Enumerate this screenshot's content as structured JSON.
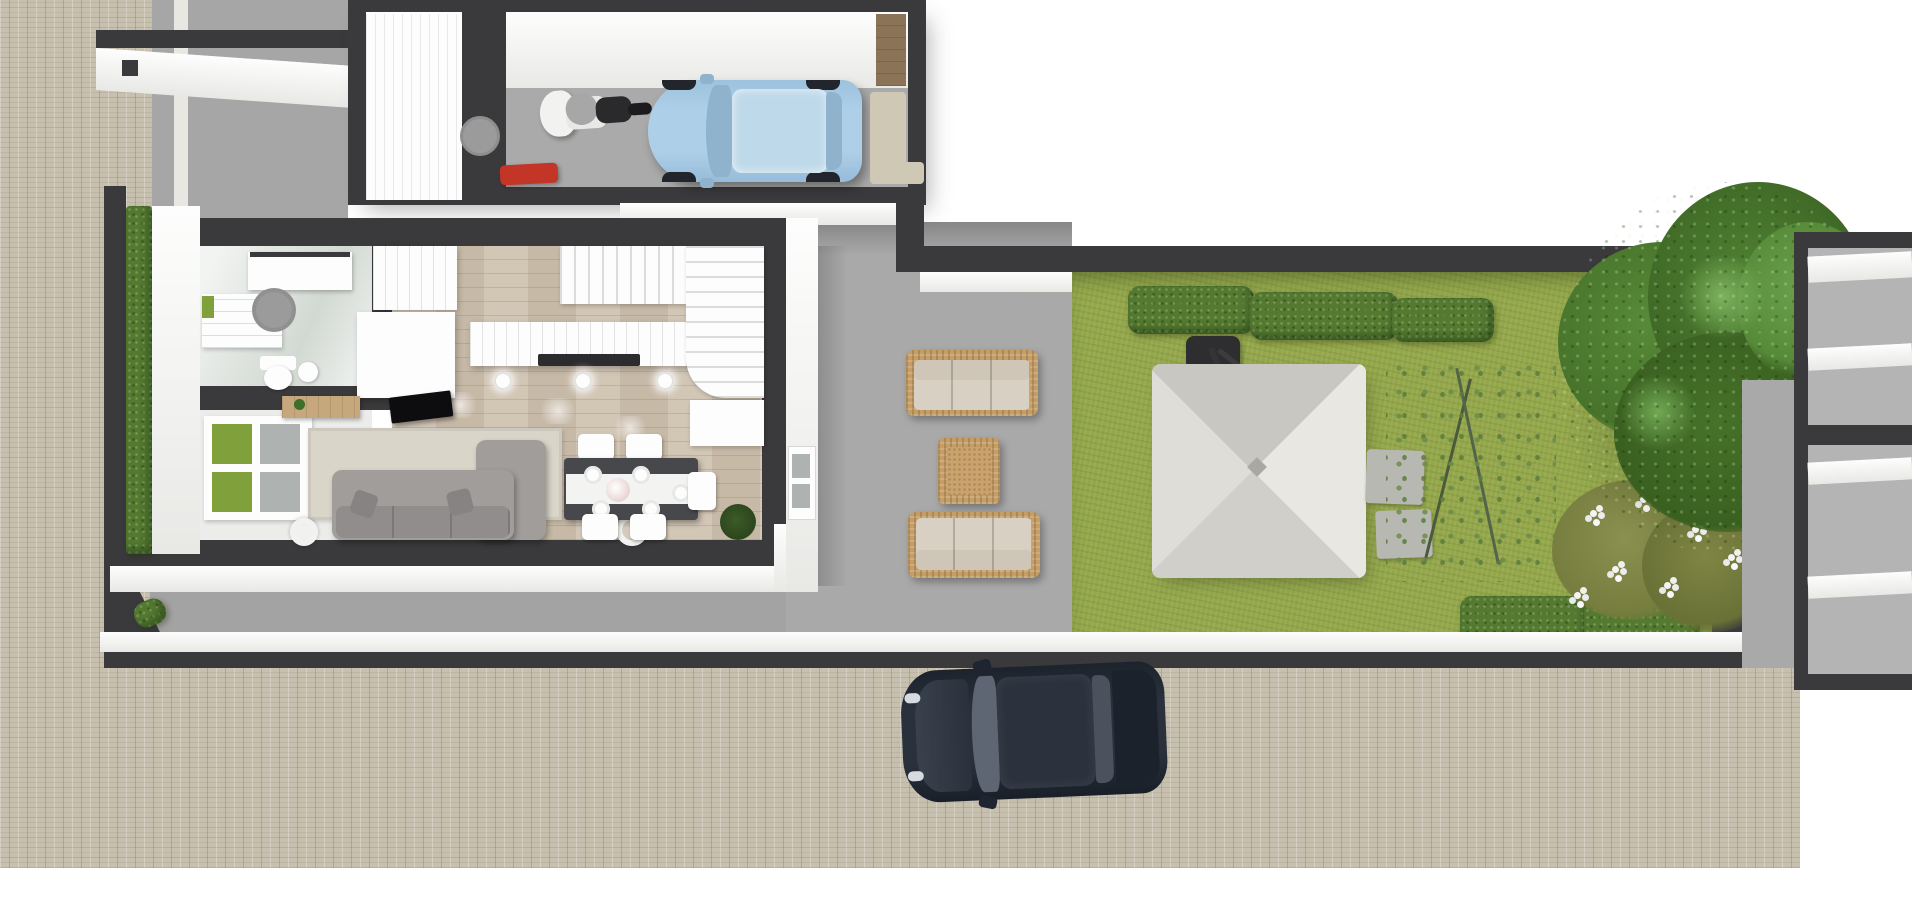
{
  "meta": {
    "type": "3d-floorplan-top-view-render",
    "description": "Photorealistic top-down 3D floor plan render of a terraced house plot: garage wing with light-blue hatchback and scooter, living floor with bathroom, kitchen, dining set, sofa and staircase, gray concrete patio with rattan lounge set, lawn garden with cantilever parasol, hedges, flowering shrub and large tree, brick-paved sidewalk with a parked dark car, neighbouring structures at the edges."
  },
  "palette": {
    "paver": "#c7c0af",
    "concrete": "#a6a6a6",
    "patio": "#a9a9a9",
    "yard": "#a3a3a3",
    "garageFloor": "#aaaaaa",
    "wallDark": "#3a3a3c",
    "wallShadow": "#4a4a4c",
    "whiteFace": "#f4f4f2",
    "pureWhite": "#fdfdfd",
    "edgeLight": "#e9e7e2",
    "wood": "#cdc0ae",
    "tileFloor": "#e3e7e3",
    "entryFloor": "#ececea",
    "grass": "#94a74a",
    "hedge": "#547a30",
    "treeDark": "#477229",
    "treeMid": "#568a38",
    "treeLight": "#6ba34c",
    "oliveBush": "#7e8544",
    "carBlue": "#a9cbe4",
    "carBlueGlass": "#bed9ea",
    "carBlueShade": "#8fb3cd",
    "carDark": "#232a35",
    "carDarkRoof": "#2b323d",
    "carDarkGlass": "#5d6672",
    "carDarkTrunk": "#1c222b",
    "wicker": "#c49e66",
    "cushion": "#d8d0c2",
    "rug": "#dad5c9",
    "sofa": "#a09d9b",
    "sofaBack": "#908d8c",
    "pillow": "#868382",
    "tableDark": "#46484b",
    "runnerWhite": "#f3f3f1",
    "sideboard": "#c7a87c",
    "parasol": "#d9d8d3",
    "stone": "#b8b8b3",
    "glassGreen": "#7fa03b",
    "glassGray": "#aeb2b1",
    "toolboxRed": "#c23527",
    "shelfTan": "#cfc8b4",
    "boxBrown": "#8a7356",
    "lampGray": "#9b9b9b",
    "cooktop": "#2c2c2e",
    "tvBlack": "#0d0d10",
    "plantGreen": "#3f6d2a",
    "neighborGray": "#b4b4b4"
  },
  "rooms": [
    {
      "name": "garage",
      "floor": "concrete",
      "contents": [
        "storage-door",
        "scooter",
        "blue-hatchback",
        "toolbox",
        "shelving"
      ]
    },
    {
      "name": "bathroom",
      "floor": "light-tile",
      "contents": [
        "washing-machine",
        "vanity",
        "stool",
        "toilet",
        "sink"
      ]
    },
    {
      "name": "entry-hall",
      "floor": "white",
      "contents": [
        "front-door-glass-panes"
      ]
    },
    {
      "name": "kitchen",
      "floor": "wood",
      "contents": [
        "counter",
        "cooktop",
        "pendant-lights",
        "island"
      ]
    },
    {
      "name": "living-dining",
      "floor": "wood",
      "contents": [
        "sofa",
        "chaise",
        "rug",
        "tv",
        "sideboard",
        "dining-table",
        "chairs",
        "floor-lamps",
        "plant"
      ]
    },
    {
      "name": "staircase",
      "type": "u-shaped-winder"
    }
  ],
  "outdoor": [
    {
      "name": "patio",
      "surface": "concrete",
      "contents": [
        "rattan-sofa-north",
        "rattan-coffee-table",
        "rattan-sofa-south"
      ]
    },
    {
      "name": "garden",
      "surface": "lawn",
      "contents": [
        "cantilever-parasol",
        "hedge-blocks-north",
        "hedge-blocks-south",
        "stepping-stones",
        "flowering-shrub",
        "large-tree",
        "twiggy-shrub"
      ]
    },
    {
      "name": "sidewalk",
      "surface": "brick-pavers",
      "contents": [
        "parked-dark-car"
      ]
    },
    {
      "name": "front-wall",
      "type": "low-white-capped-wall"
    }
  ],
  "vehicles": [
    {
      "name": "blue-hatchback",
      "color": "#a9cbe4",
      "location": "garage",
      "heading": "west"
    },
    {
      "name": "scooter",
      "color": "#ffffff",
      "location": "garage"
    },
    {
      "name": "dark-car",
      "color": "#232a35",
      "location": "sidewalk",
      "heading": "west"
    }
  ]
}
